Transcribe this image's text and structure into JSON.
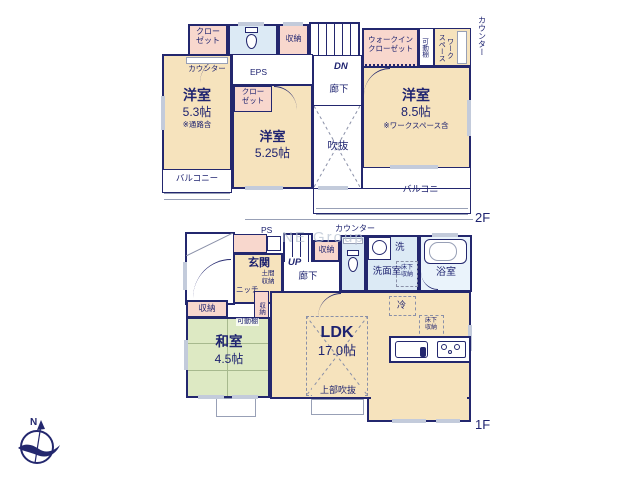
{
  "watermark": "NE Group",
  "compass": {
    "north": "N"
  },
  "colors": {
    "wall": "#23276e",
    "text": "#1e2370",
    "cream": "#f6e3bd",
    "pink": "#f8d7cd",
    "blue": "#dceaf5",
    "green": "#dde9c3"
  },
  "floor2": {
    "label": "2F",
    "closet_top_left": "クロー\nゼット",
    "counter_desk": "カウンター",
    "storage_top": "収納",
    "stairs_dn": "DN",
    "eps": "EPS",
    "hallway": "廊下",
    "room_53": {
      "name": "洋室",
      "size": "5.3帖",
      "note": "※通路含"
    },
    "closet_525": "クロー\nゼット",
    "room_525": {
      "name": "洋室",
      "size": "5.25帖"
    },
    "void": "吹抜",
    "wic": "ウォークイン\nクローゼット",
    "movable_shelf": "可動棚",
    "workspace": "ワーク\nスペース",
    "counter_right": "カウンター",
    "room_85": {
      "name": "洋室",
      "size": "8.5帖",
      "note": "※ワークスペース含"
    },
    "balcony_left": "バルコニー",
    "balcony_right": "バルコニー"
  },
  "floor1": {
    "label": "1F",
    "ps": "PS",
    "counter_top": "カウンター",
    "entrance": "玄関",
    "doma_storage": "土間\n収納",
    "niche": "ニッチ",
    "stairs_up": "UP",
    "hallway": "廊下",
    "storage_hall": "収納",
    "washer": "洗",
    "washroom": "洗面室",
    "underfloor_wash": "床下\n収納",
    "bathroom": "浴室",
    "fridge": "冷",
    "storage_left": "収納",
    "storage_strip": "収納",
    "movable_shelf": "可動棚",
    "washitsu": {
      "name": "和室",
      "size": "4.5帖"
    },
    "ldk": {
      "name": "LDK",
      "size": "17.0帖"
    },
    "upper_void": "上部吹抜",
    "underfloor_kitchen": "床下\n収納"
  }
}
